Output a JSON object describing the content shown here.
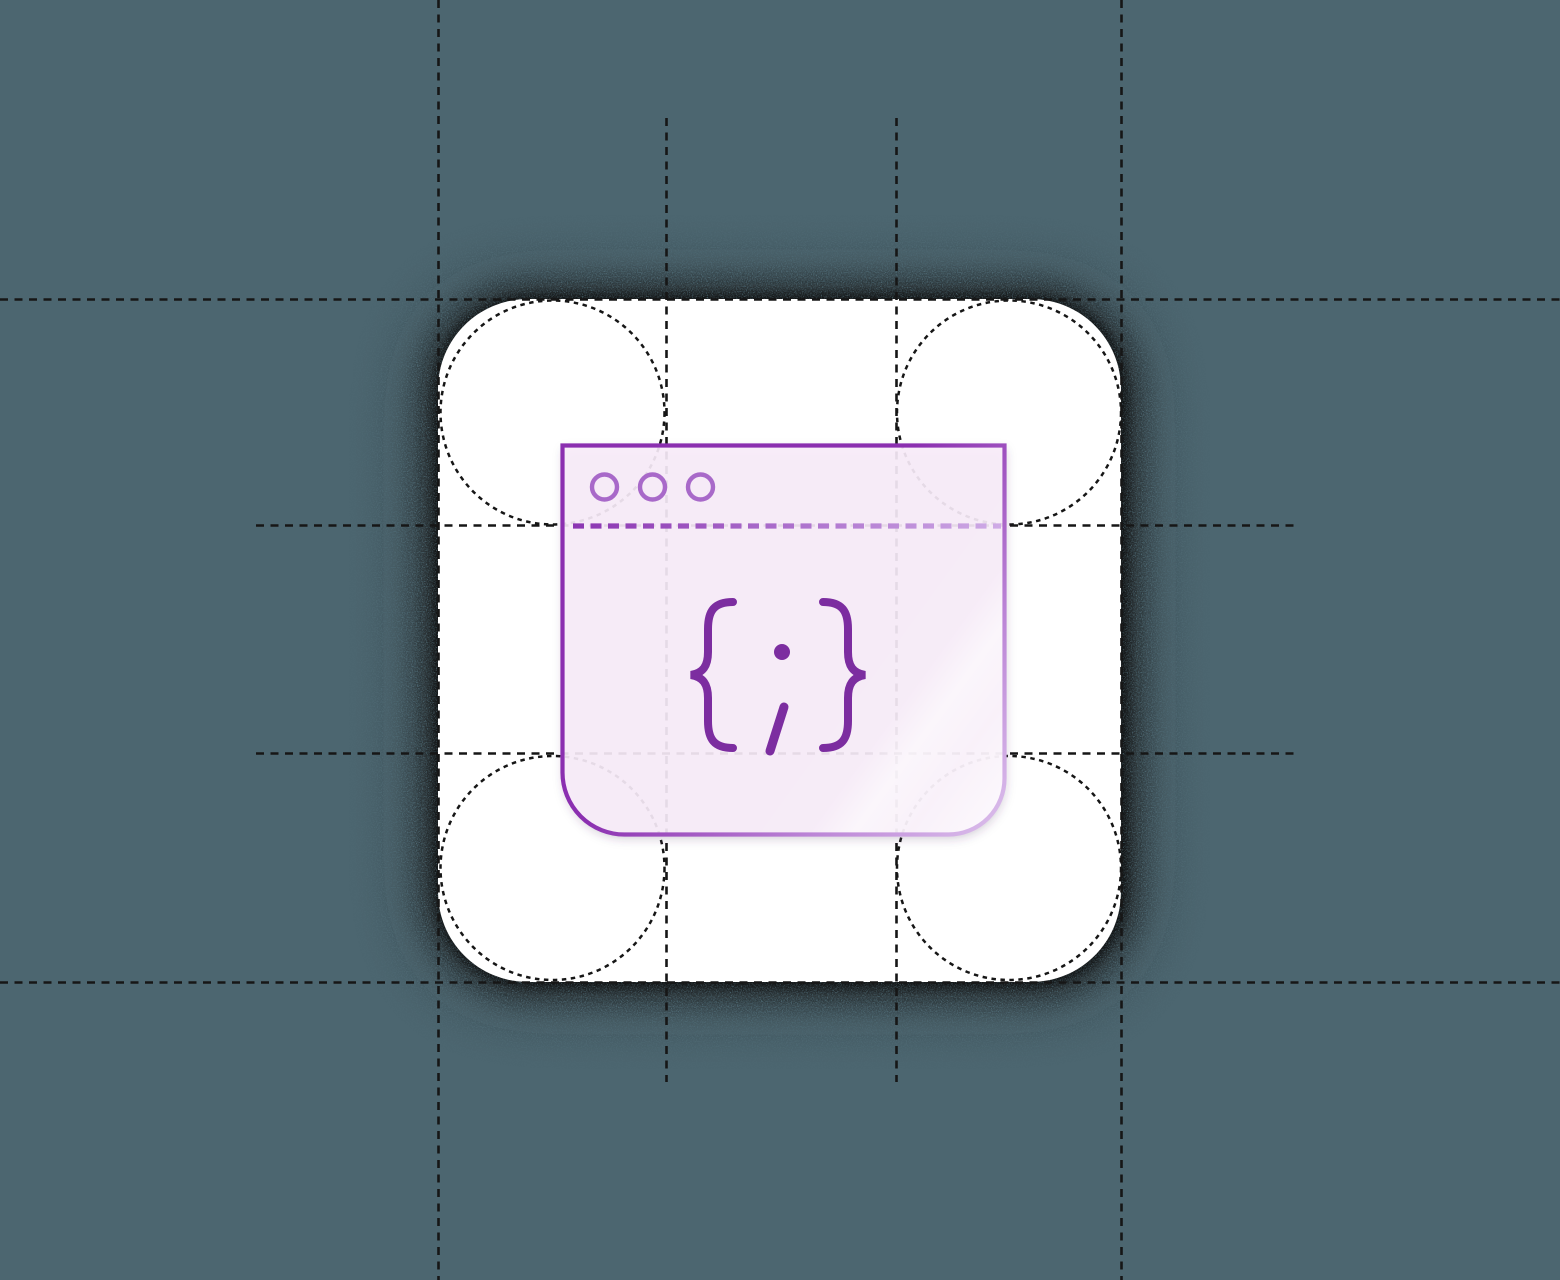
{
  "scene": {
    "title": "code-window-app-icon-illustration",
    "code_symbol": "{ ; }"
  },
  "colors": {
    "background": "#4C6670",
    "tile": "#FFFFFF",
    "grid_line": "#161616",
    "shadow_outer": "#262626",
    "shadow_mid": "#151515",
    "shadow_inner": "#0B0B0B",
    "window_fill": "#F8ECFA",
    "window_border_dark": "#8B2FB0",
    "window_border_mid": "#BB84D6",
    "window_border_light": "#DCC0EC",
    "traffic_light": "#A869C9",
    "separator_dark": "#8B35B2",
    "separator_light": "#CDA8E5",
    "code_glyph": "#7C2DA0",
    "sheen": "#FFFFFF"
  }
}
